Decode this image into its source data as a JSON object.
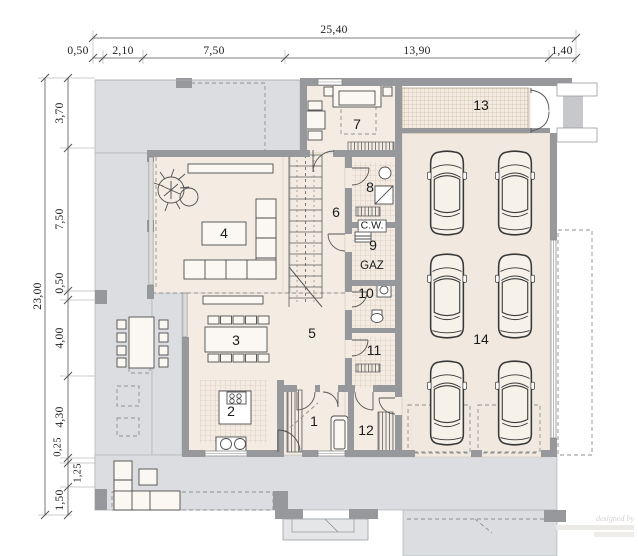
{
  "drawing": {
    "type": "architectural-floor-plan",
    "colors": {
      "terrace": "#dbdde0",
      "floor": "#f4ece3",
      "wall": "#96989b",
      "hatch_strip": "#b9a583",
      "line": "#4d4d4d"
    },
    "rooms": [
      {
        "number": "1"
      },
      {
        "number": "2"
      },
      {
        "number": "3"
      },
      {
        "number": "4"
      },
      {
        "number": "5"
      },
      {
        "number": "6"
      },
      {
        "number": "7"
      },
      {
        "number": "8"
      },
      {
        "number": "9"
      },
      {
        "number": "10"
      },
      {
        "number": "11"
      },
      {
        "number": "12"
      },
      {
        "number": "13"
      },
      {
        "number": "14"
      }
    ],
    "utility_labels": {
      "cw": "C.W.",
      "gaz": "GAZ"
    },
    "dimensions": {
      "top": {
        "overall": "25,40",
        "segments": [
          "0,50",
          "2,10",
          "7,50",
          "13,90",
          "1,40"
        ]
      },
      "left": {
        "overall": "23,00",
        "segments": [
          "3,70",
          "7,50",
          "0,50",
          "4,00",
          "4,30",
          "0,25",
          "1,25",
          "1,50"
        ]
      }
    },
    "watermark": "designed by"
  }
}
